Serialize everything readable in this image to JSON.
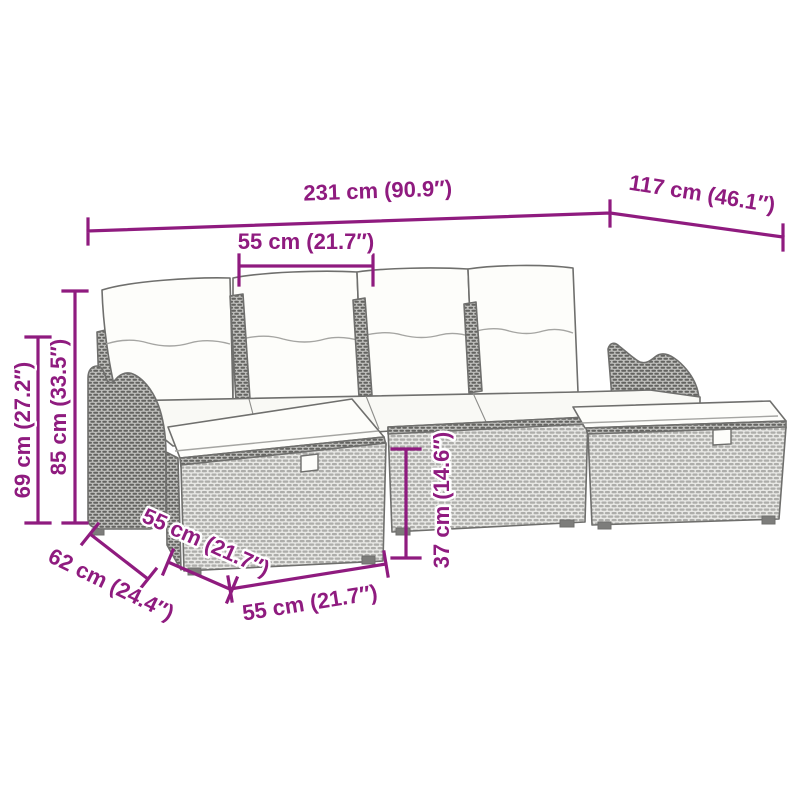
{
  "image": {
    "type": "product-dimension-diagram",
    "subject": "poly-rattan garden sofa set with cushions and ottomans",
    "background_color": "#ffffff",
    "dimension_color": "#8f1b7f",
    "line_art_color": "#6f6f6d"
  },
  "dimensions": {
    "overall_width": "231 cm (90.9″)",
    "overall_depth": "117 cm (46.1″)",
    "seat_width": "55 cm (21.7″)",
    "arm_height": "69 cm (27.2″)",
    "back_height": "85 cm (33.5″)",
    "ottoman_depth": "62 cm (24.4″)",
    "ottoman_side_width": "55 cm (21.7″)",
    "ottoman_front_width": "55 cm (21.7″)",
    "seat_height": "37 cm (14.6″)"
  }
}
